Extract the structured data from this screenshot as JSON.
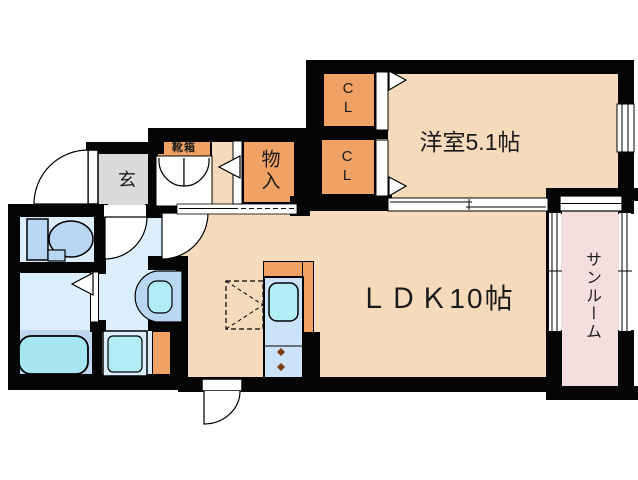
{
  "plan": {
    "type": "apartment-floor-plan",
    "rooms": {
      "bedroom": {
        "label": "洋室5.1帖"
      },
      "ldk": {
        "label": "ＬＤＫ10帖"
      },
      "sunroom": {
        "label": "サンルーム"
      },
      "entrance": {
        "label": "玄"
      },
      "shoe_box": {
        "label": "靴箱"
      },
      "storage": {
        "label": "物入"
      },
      "closet_upper": {
        "label": "CL"
      },
      "closet_lower": {
        "label": "CL"
      }
    },
    "fixtures": [
      "toilet",
      "bathtub",
      "wash-basin",
      "washing-machine",
      "kitchen-sink",
      "stove-burners",
      "refrigerator-space",
      "shoe-cabinet"
    ],
    "colors": {
      "room_floor": "#f5dabc",
      "closet_orange": "#efa263",
      "entrance_gray": "#dbdbdb",
      "wet_room_blue": "#dceefc",
      "fixture_blue": "#b9d6f2",
      "fixture_cyan": "#aeeaf4",
      "counter_blue": "#cbe2f8",
      "tub_zone_blue": "#c0d6f0",
      "sunroom_pink": "#f4dede",
      "wall": "#000000"
    }
  }
}
